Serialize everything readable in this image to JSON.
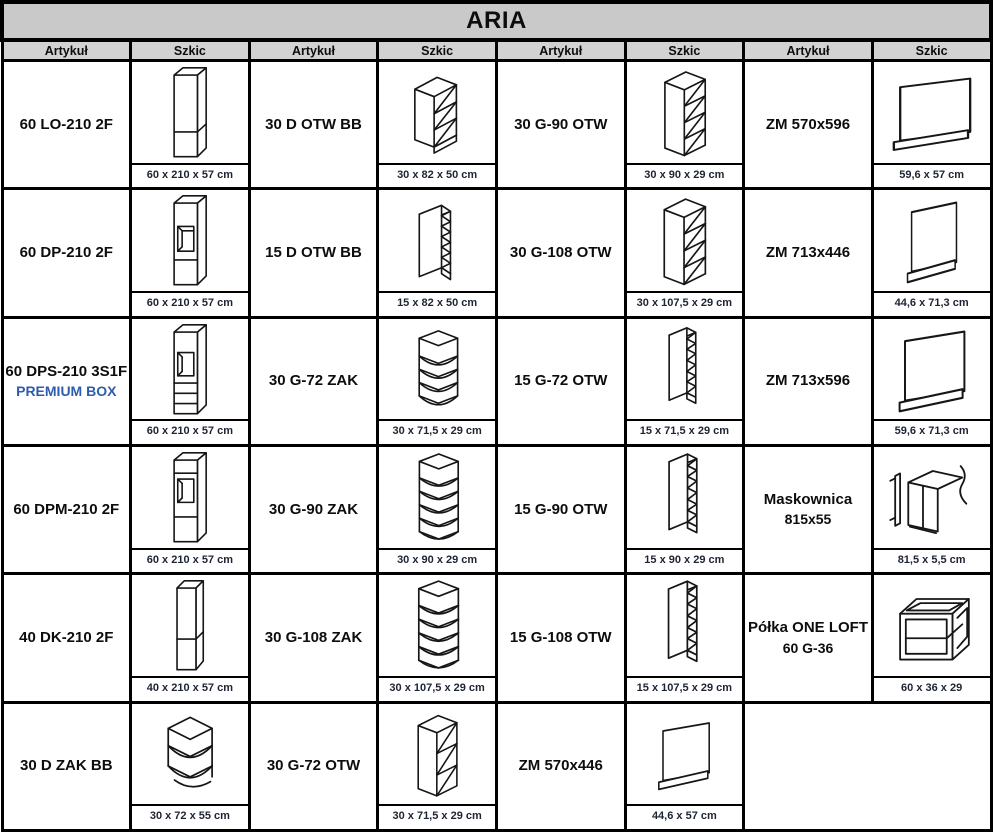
{
  "title": "ARIA",
  "column_headers": [
    "Artykuł",
    "Szkic",
    "Artykuł",
    "Szkic",
    "Artykuł",
    "Szkic",
    "Artykuł",
    "Szkic"
  ],
  "colors": {
    "title_bar_bg": "#c9c9c9",
    "header_bg": "#d2d2d2",
    "border": "#000000",
    "text": "#0d0d0d",
    "premium_box_blue": "#2e5cac",
    "dimension_text": "#1d2433"
  },
  "rows": [
    {
      "groups": [
        {
          "article": "60 LO-210 2F",
          "sketch": "tall-cabinet-2-fronts",
          "dimensions": "60 x 210 x 57 cm"
        },
        {
          "article": "30 D OTW BB",
          "sketch": "open-base-cabinet",
          "dimensions": "30 x 82 x 50 cm"
        },
        {
          "article": "30 G-90 OTW",
          "sketch": "open-wall-cabinet",
          "dimensions": "30 x 90 x 29 cm"
        },
        {
          "article": "ZM 570x596",
          "sketch": "appliance-front-panel",
          "dimensions": "59,6 x 57 cm"
        }
      ]
    },
    {
      "groups": [
        {
          "article": "60 DP-210 2F",
          "sketch": "oven-housing-cabinet",
          "dimensions": "60 x 210 x 57 cm"
        },
        {
          "article": "15 D OTW BB",
          "sketch": "open-base-cabinet-slim",
          "dimensions": "15 x 82 x 50 cm"
        },
        {
          "article": "30 G-108 OTW",
          "sketch": "open-wall-cabinet",
          "dimensions": "30 x 107,5 x 29 cm"
        },
        {
          "article": "ZM 713x446",
          "sketch": "appliance-front-panel",
          "dimensions": "44,6 x 71,3 cm"
        }
      ]
    },
    {
      "groups": [
        {
          "article": "60 DPS-210 3S1F",
          "article_line2": "PREMIUM BOX",
          "sketch": "oven-housing-with-drawers",
          "dimensions": "60 x 210 x 57 cm"
        },
        {
          "article": "30 G-72 ZAK",
          "sketch": "corner-wall-shelf",
          "dimensions": "30 x 71,5 x 29 cm"
        },
        {
          "article": "15 G-72 OTW",
          "sketch": "open-wall-cabinet-slim",
          "dimensions": "15 x 71,5 x 29 cm"
        },
        {
          "article": "ZM 713x596",
          "sketch": "appliance-front-panel",
          "dimensions": "59,6 x 71,3 cm"
        }
      ]
    },
    {
      "groups": [
        {
          "article": "60 DPM-210 2F",
          "sketch": "oven-microwave-housing",
          "dimensions": "60 x 210 x 57 cm"
        },
        {
          "article": "30 G-90 ZAK",
          "sketch": "corner-wall-shelf",
          "dimensions": "30 x 90 x 29 cm"
        },
        {
          "article": "15 G-90 OTW",
          "sketch": "open-wall-cabinet-slim",
          "dimensions": "15 x 90 x 29 cm"
        },
        {
          "article": "Maskownica",
          "article_line2": "815x55",
          "sketch": "cover-strip-panel",
          "dimensions": "81,5 x 5,5 cm"
        }
      ]
    },
    {
      "groups": [
        {
          "article": "40 DK-210 2F",
          "sketch": "tall-cabinet-slim",
          "dimensions": "40 x 210 x 57 cm"
        },
        {
          "article": "30 G-108 ZAK",
          "sketch": "corner-wall-shelf",
          "dimensions": "30 x 107,5 x 29 cm"
        },
        {
          "article": "15 G-108 OTW",
          "sketch": "open-wall-cabinet-slim",
          "dimensions": "15 x 107,5 x 29 cm"
        },
        {
          "article": "Półka ONE LOFT",
          "article_line2": "60 G-36",
          "sketch": "open-frame-shelf",
          "dimensions": "60 x 36 x 29"
        }
      ]
    },
    {
      "groups": [
        {
          "article": "30 D ZAK BB",
          "sketch": "corner-base-open-cabinet",
          "dimensions": "30 x 72 x 55 cm"
        },
        {
          "article": "30 G-72 OTW",
          "sketch": "open-wall-cabinet",
          "dimensions": "30 x 71,5 x 29 cm"
        },
        {
          "article": "ZM 570x446",
          "sketch": "appliance-front-panel",
          "dimensions": "44,6 x 57 cm"
        }
      ]
    }
  ]
}
